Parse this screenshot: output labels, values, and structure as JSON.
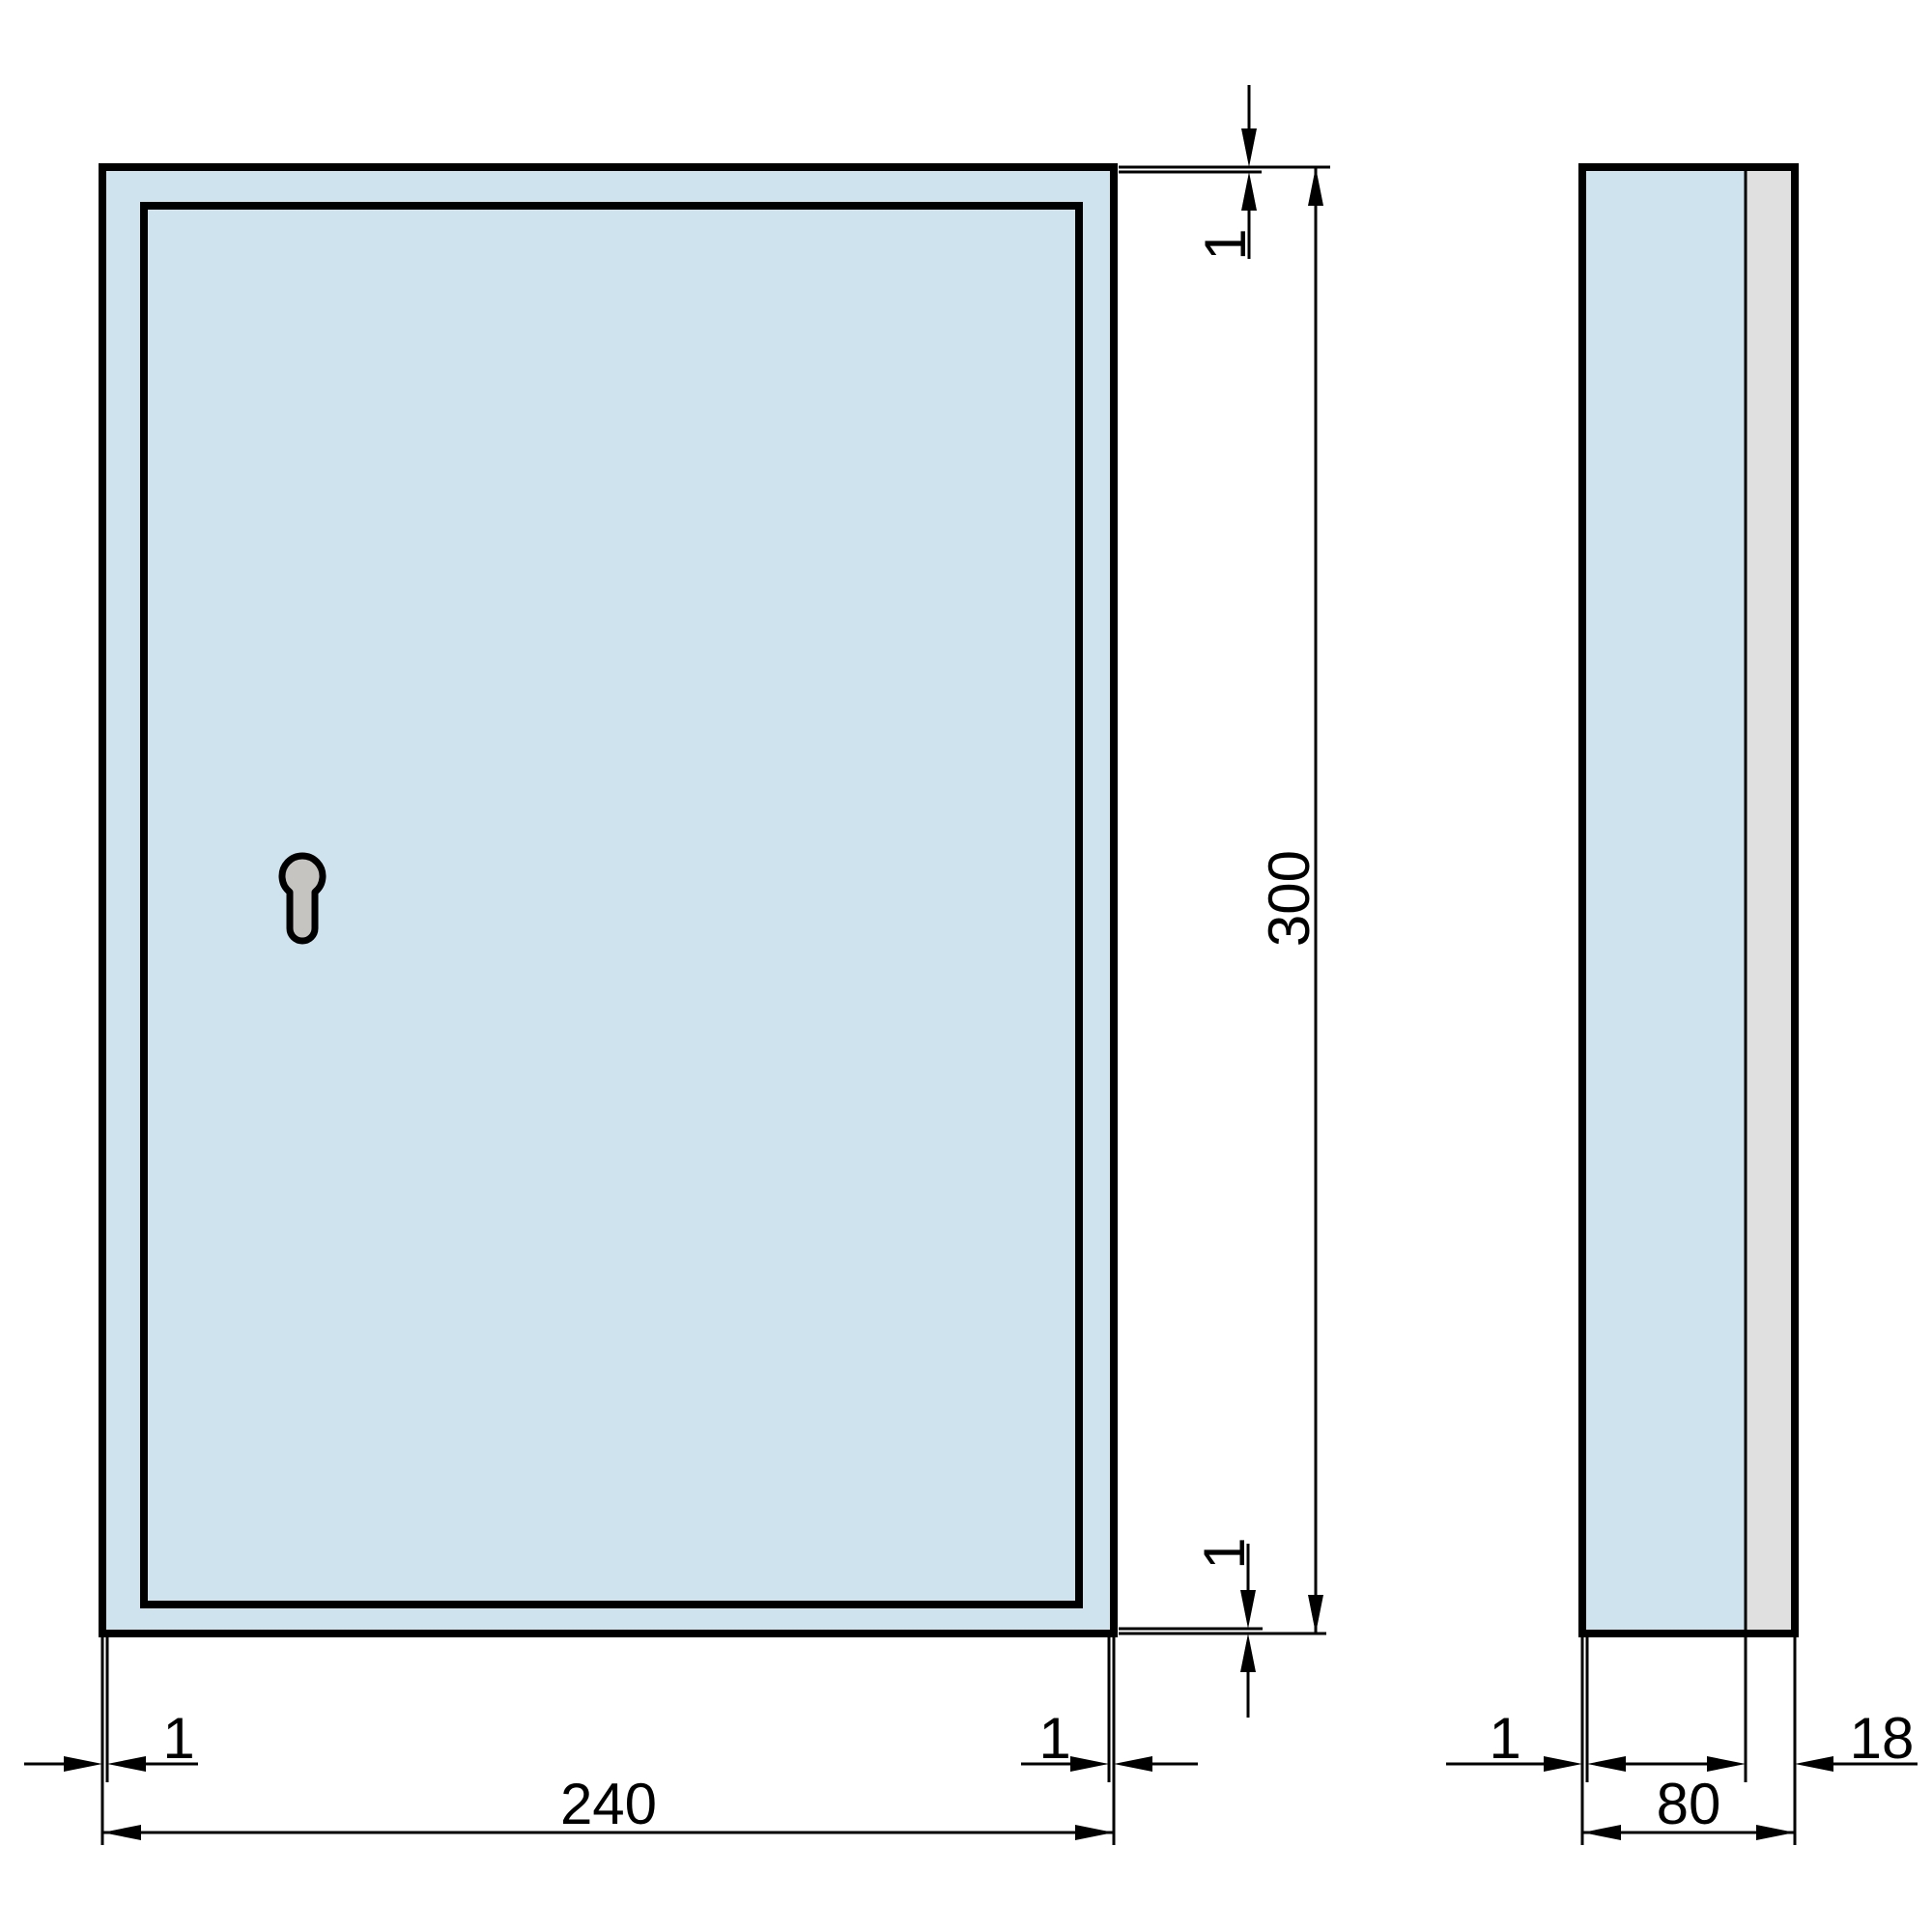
{
  "drawing": {
    "background": "#ffffff",
    "colors": {
      "view_fill": "#cfe3ef",
      "back_panel_fill": "#e0e0e0",
      "keyhole_fill": "#c6c4c1",
      "line": "#000000"
    },
    "front_view": {
      "width_label": "240",
      "height_label": "300",
      "gap_top_label": "1",
      "gap_bottom_label": "1",
      "gap_left_label": "1",
      "gap_right_label": "1"
    },
    "side_view": {
      "depth_label": "80",
      "back_panel_label": "18",
      "front_sheet_label": "1"
    }
  }
}
